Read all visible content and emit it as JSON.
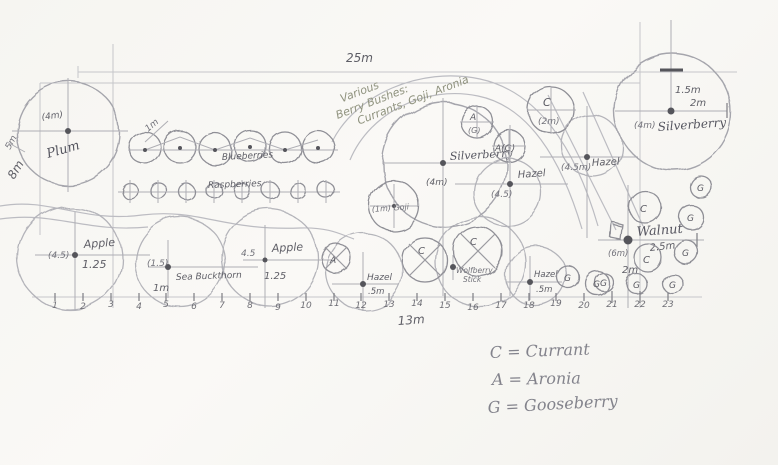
{
  "labels": {
    "top_width": "25m",
    "left_height_small": "5m",
    "left_height": "8m",
    "bottom_width": "13m"
  },
  "note": {
    "l1": "Various",
    "l2": "Berry Bushes:",
    "l3": "Currants, Goji, Aronia"
  },
  "plants": {
    "plum": {
      "name": "Plum",
      "size": "(4m)"
    },
    "blueberries": {
      "name": "Blueberries",
      "spacing": "1m"
    },
    "raspberries": {
      "name": "Raspberries"
    },
    "silverberry_center": {
      "name": "Silverberry",
      "size": "(4m)"
    },
    "goji": {
      "name": "(1m) Goji"
    },
    "aronia_small": {
      "a": "A",
      "g": "(G)",
      "combo": "A(G)"
    },
    "currant_top": {
      "symbol": "C",
      "size": "(2m)"
    },
    "hazel_upper_left": {
      "name": "Hazel",
      "size": "(4.5)"
    },
    "hazel_upper_right": {
      "name": "Hazel",
      "size": "(4.5m)"
    },
    "silverberry_right": {
      "name": "Silverberry",
      "size": "(4m)",
      "h": "1.5m",
      "w": "2m"
    },
    "walnut": {
      "name": "Walnut",
      "size": "(6m)",
      "d1": "2.5m",
      "d2": "2m"
    },
    "apple_west": {
      "name": "Apple",
      "size": "(4.5)",
      "spacing": "1.25"
    },
    "sea_buckthorn": {
      "name": "Sea Buckthorn",
      "size": "(1.5)",
      "spacing": "1m"
    },
    "apple_mid": {
      "name": "Apple",
      "size": "4.5",
      "spacing": "1.25"
    },
    "hazel_lower_mid": {
      "name": "Hazel",
      "spacing": ".5m"
    },
    "hazel_lower_east": {
      "name": "Hazel",
      "spacing": ".5m"
    },
    "wolfberry": {
      "l1": "Wolfberry",
      "l2": "Stick"
    }
  },
  "letters": {
    "c": "C",
    "a": "A",
    "g": "G"
  },
  "axis": {
    "ticks": [
      "1",
      "2",
      "3",
      "4",
      "5",
      "6",
      "7",
      "8",
      "9",
      "10",
      "11",
      "12",
      "13",
      "14",
      "15",
      "16",
      "17",
      "18",
      "19",
      "20",
      "21",
      "22",
      "23"
    ]
  },
  "legend": {
    "items": [
      "C = Currant",
      "A = Aronia",
      "G = Gooseberry"
    ]
  },
  "colors": {
    "pencil": "#8f8f96",
    "pencil_light": "#c6c6ca",
    "note_green": "#8f927e",
    "paper": "#f7f6f2"
  }
}
